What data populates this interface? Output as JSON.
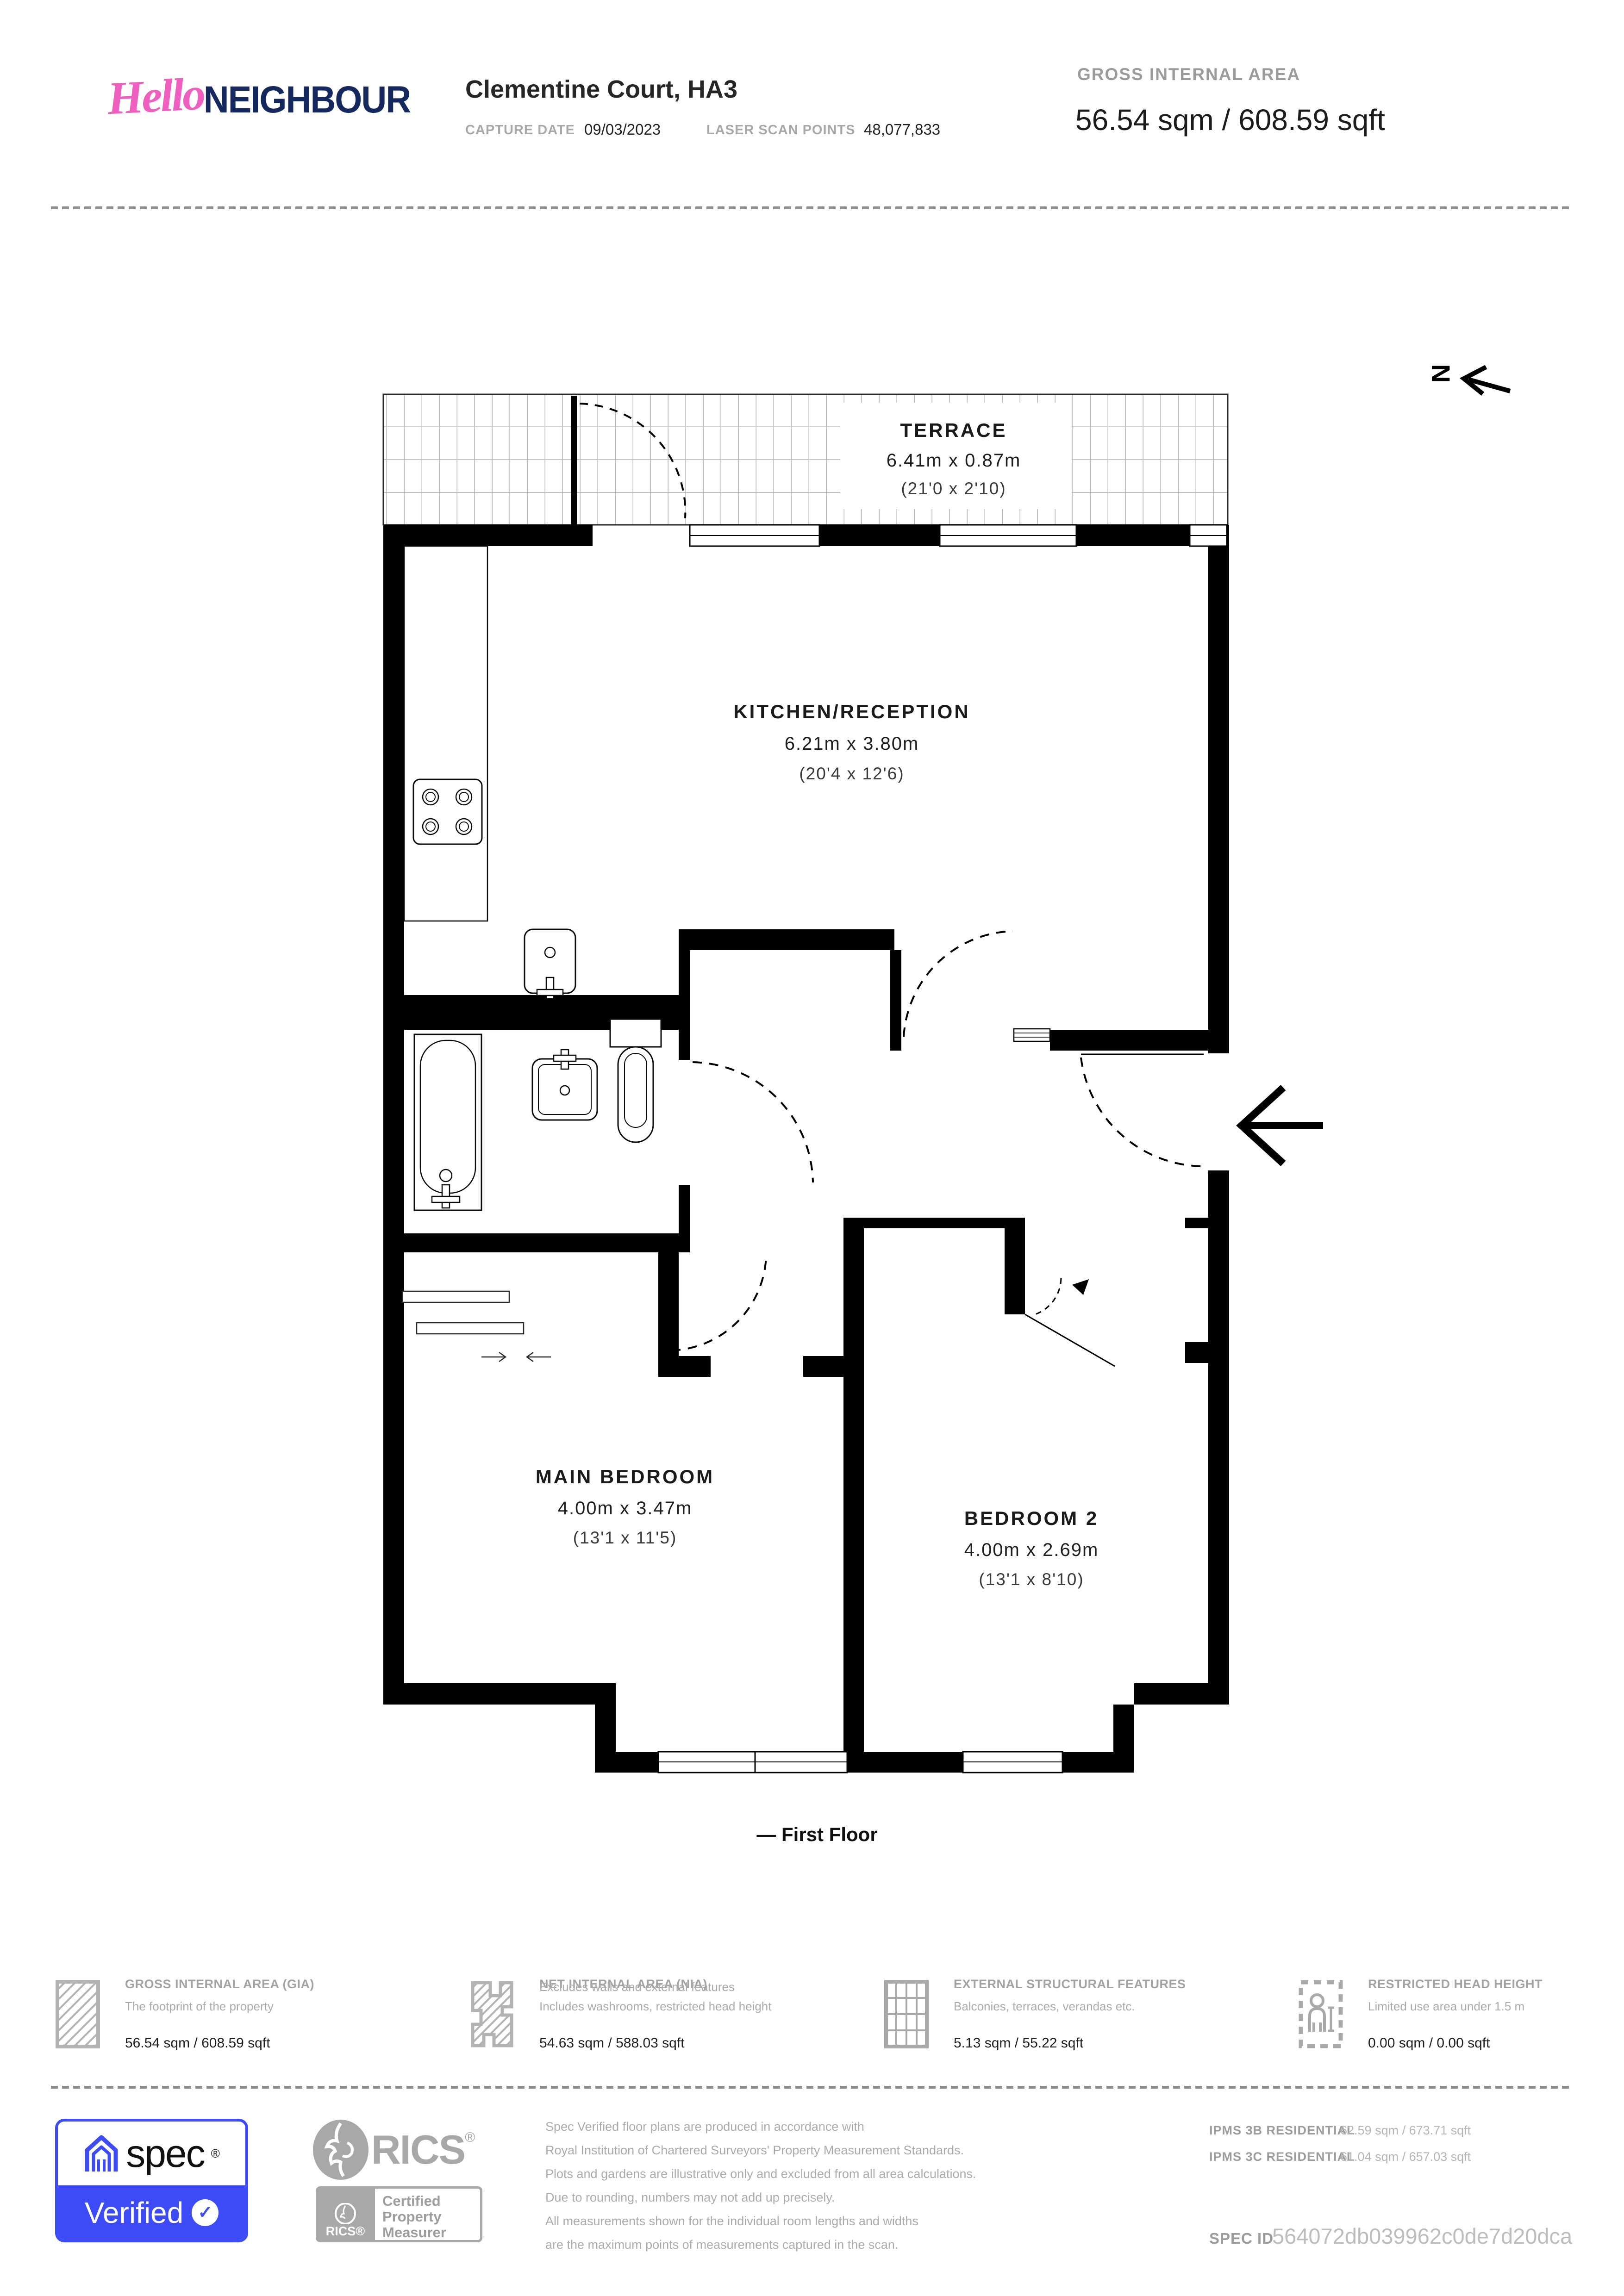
{
  "header": {
    "logo_hello": "Hello",
    "logo_neighbour": "NEIGHBOUR",
    "property_title": "Clementine Court, HA3",
    "capture_date_label": "CAPTURE DATE",
    "capture_date": "09/03/2023",
    "laser_label": "LASER SCAN POINTS",
    "laser_points": "48,077,833",
    "gia_label": "GROSS INTERNAL AREA",
    "gia_value": "56.54 sqm / 608.59 sqft"
  },
  "plan": {
    "floor_label": "— First Floor",
    "north_label": "N",
    "rooms": {
      "terrace": {
        "name": "TERRACE",
        "metric": "6.41m x 0.87m",
        "imperial": "(21'0 x 2'10)"
      },
      "kitchen": {
        "name": "KITCHEN/RECEPTION",
        "metric": "6.21m x 3.80m",
        "imperial": "(20'4 x 12'6)"
      },
      "main_bedroom": {
        "name": "MAIN BEDROOM",
        "metric": "4.00m x 3.47m",
        "imperial": "(13'1 x 11'5)"
      },
      "bedroom2": {
        "name": "BEDROOM 2",
        "metric": "4.00m x 2.69m",
        "imperial": "(13'1 x 8'10)"
      }
    }
  },
  "legend": {
    "items": [
      {
        "label": "GROSS INTERNAL AREA (GIA)",
        "desc1": "The footprint of the property",
        "value": "56.54 sqm / 608.59 sqft"
      },
      {
        "label": "NET INTERNAL AREA (NIA)",
        "desc1": "Excludes walls and external features",
        "desc2": "Includes washrooms, restricted head height",
        "value": "54.63 sqm / 588.03 sqft"
      },
      {
        "label": "EXTERNAL STRUCTURAL FEATURES",
        "desc1": "Balconies, terraces, verandas etc.",
        "value": "5.13 sqm / 55.22 sqft"
      },
      {
        "label": "RESTRICTED HEAD HEIGHT",
        "desc1": "Limited use area under 1.5 m",
        "value": "0.00 sqm / 0.00 sqft"
      }
    ]
  },
  "footer": {
    "spec_brand": "spec",
    "spec_reg": "®",
    "spec_verified": "Verified",
    "check": "✓",
    "rics_word": "RICS",
    "rics_reg": "®",
    "rics_badge_brand": "RICS®",
    "rics_badge_line1": "Certified",
    "rics_badge_line2": "Property",
    "rics_badge_line3": "Measurer",
    "disclaimer_lines": [
      "Spec Verified floor plans are produced in accordance with",
      "Royal Institution of Chartered Surveyors' Property Measurement Standards.",
      "Plots and gardens are illustrative only and excluded from all area calculations.",
      "Due to rounding, numbers may not add up precisely.",
      "All measurements shown for the individual room lengths and widths",
      "are the maximum points of measurements captured in the scan."
    ],
    "ipms": [
      {
        "label": "IPMS 3B RESIDENTIAL",
        "value": "62.59 sqm / 673.71 sqft"
      },
      {
        "label": "IPMS 3C RESIDENTIAL",
        "value": "61.04 sqm / 657.03 sqft"
      }
    ],
    "spec_id_label": "SPEC ID",
    "spec_id": "564072db039962c0de7d20dca"
  },
  "colors": {
    "pink": "#ef5fc0",
    "navy": "#15295e",
    "spec_blue": "#3c4bf6",
    "gray": "#a8a8a8"
  }
}
